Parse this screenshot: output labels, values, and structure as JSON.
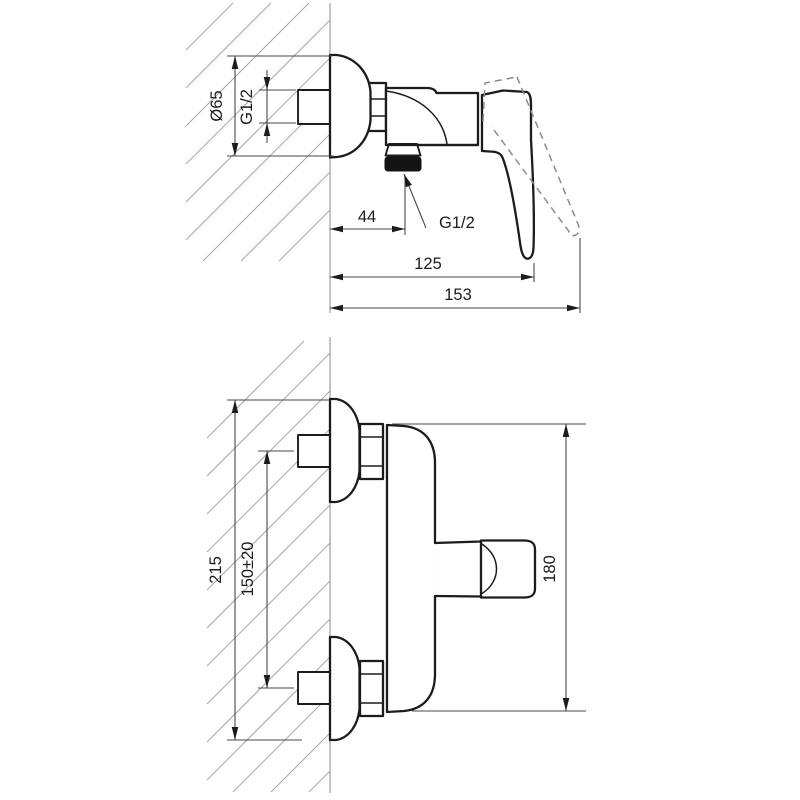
{
  "drawing": {
    "type": "technical-dimension-drawing",
    "subject": "wall-mounted single-lever shower mixer, two views",
    "colors": {
      "background": "#ffffff",
      "outline": "#1c1c1c",
      "dimension": "#4a4a4a",
      "construction": "#9c9c9c",
      "dashed_alternate_position": "#8c8c8c",
      "thread_fill": "#141414"
    },
    "side_view": {
      "labels": {
        "diameter": "Ø65",
        "inlet_thread": "G1/2",
        "outlet_offset": "44",
        "outlet_thread": "G1/2",
        "depth_closed": "125",
        "depth_open": "153"
      }
    },
    "front_view": {
      "labels": {
        "overall_height": "215",
        "connection_spacing": "150±20",
        "body_length": "180"
      }
    }
  }
}
